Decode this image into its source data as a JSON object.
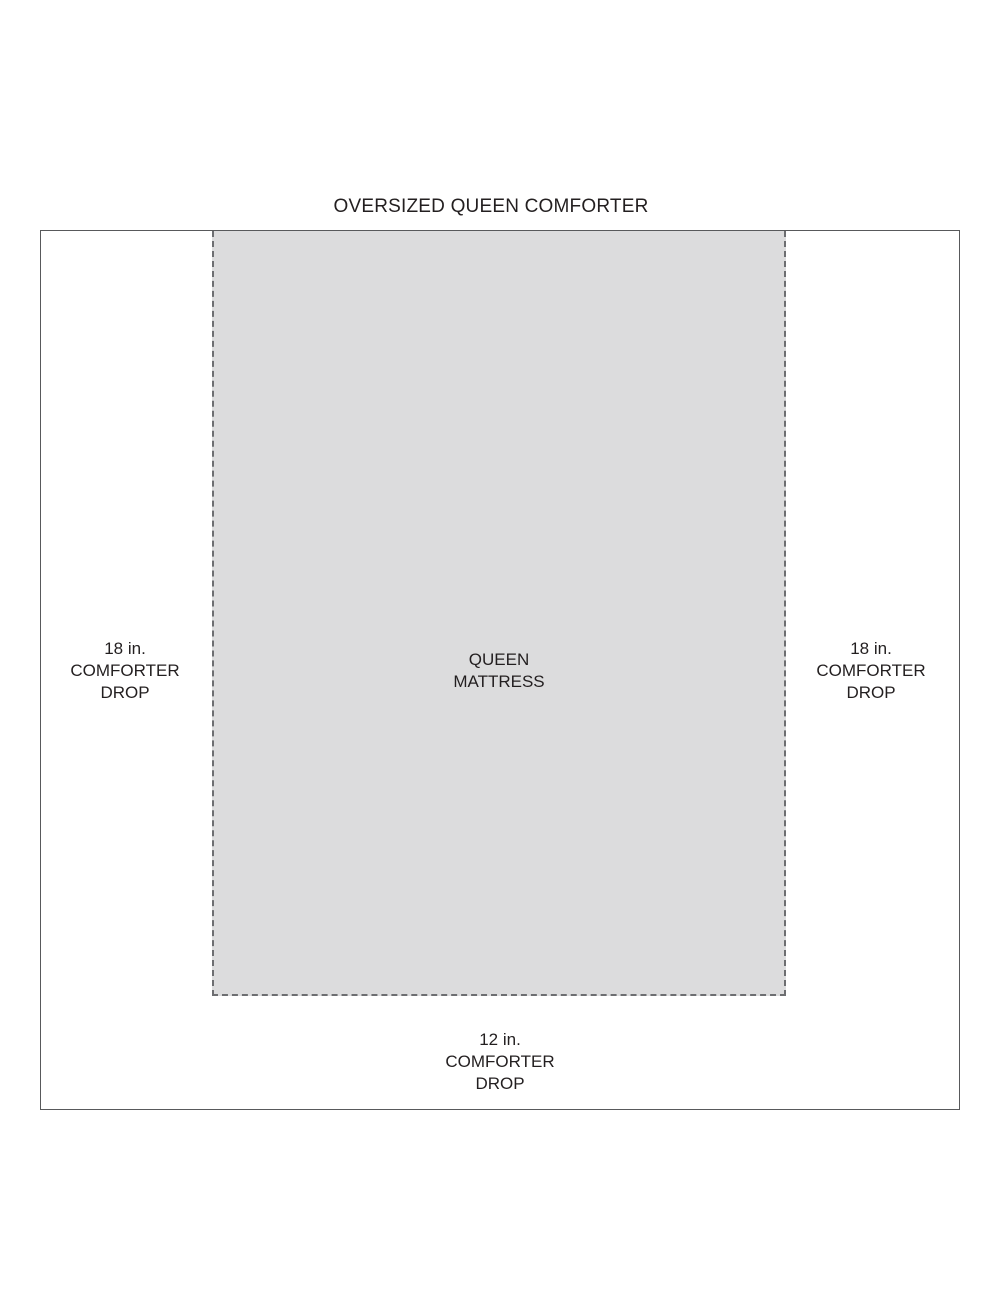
{
  "title": "OVERSIZED QUEEN COMFORTER",
  "mattress": {
    "line1": "QUEEN",
    "line2": "MATTRESS"
  },
  "left_drop": {
    "line1": "18 in.",
    "line2": "COMFORTER",
    "line3": "DROP"
  },
  "right_drop": {
    "line1": "18 in.",
    "line2": "COMFORTER",
    "line3": "DROP"
  },
  "bottom_drop": {
    "line1": "12 in.",
    "line2": "COMFORTER",
    "line3": "DROP"
  },
  "colors": {
    "background": "#ffffff",
    "text": "#231f20",
    "comforter_outline": "#58595b",
    "mattress_dash": "#6d6e71",
    "mattress_fill": "#dcdcdd"
  }
}
